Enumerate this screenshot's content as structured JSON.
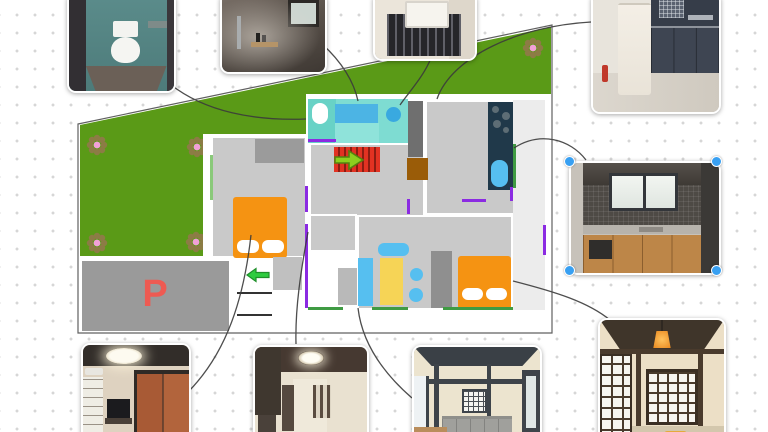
{
  "canvas": {
    "type": "floor-plan-photo-board",
    "background": "dot-grid"
  },
  "parking": {
    "label": "P",
    "color": "#ee5a52"
  },
  "palette": {
    "yard_green": "#5a9a17",
    "room_gray": "#c9c9c9",
    "bath_cyan": "#7edcd2",
    "water_blue": "#4fb9ee",
    "bed_orange": "#f59312",
    "stairs_red": "#e23222",
    "kitchen_navy": "#20394a",
    "entry_brown": "#9a5c08",
    "accent_purple": "#8b2be2",
    "accent_green": "#3f9b43",
    "selection_blue": "#38a0f2",
    "flower_petal": "#8c7c45",
    "flower_center": "#f2a0d8"
  },
  "photos": [
    {
      "id": "toilet-photo",
      "subject": "toilet room"
    },
    {
      "id": "shower-photo",
      "subject": "bathroom shower"
    },
    {
      "id": "sink-photo",
      "subject": "washbasin on rack"
    },
    {
      "id": "fridge-photo",
      "subject": "kitchen with refrigerator"
    },
    {
      "id": "counter-photo",
      "subject": "kitchen counter",
      "selected": true
    },
    {
      "id": "shoji-photo",
      "subject": "japanese room with shoji and pendant lamp"
    },
    {
      "id": "living-photo",
      "subject": "living room with sofa"
    },
    {
      "id": "hallway-photo",
      "subject": "hallway with stairs"
    },
    {
      "id": "tv-photo",
      "subject": "bedroom with tv and fusuma"
    }
  ],
  "selection": {
    "selected_photo": "counter-photo",
    "handle_color": "#38a0f2",
    "handles": 4
  },
  "plan": {
    "elements": [
      "yard",
      "flowers-x5",
      "toilet",
      "bathtub",
      "washbasin",
      "stairs-up-arrow",
      "entrance-mat",
      "kitchen-counter-stove-sink",
      "west-bed",
      "east-bed",
      "sofa",
      "dining-table",
      "stools",
      "tv-board",
      "closet",
      "parking",
      "entry-steps",
      "entry-arrow"
    ]
  },
  "connections": [
    {
      "from": "toilet-photo",
      "to": "plan-toilet"
    },
    {
      "from": "shower-photo",
      "to": "plan-bathtub"
    },
    {
      "from": "sink-photo",
      "to": "plan-washbasin"
    },
    {
      "from": "fridge-photo",
      "to": "plan-kitchen-room"
    },
    {
      "from": "counter-photo",
      "to": "plan-kitchen-counter"
    },
    {
      "from": "shoji-photo",
      "to": "plan-east-bed"
    },
    {
      "from": "living-photo",
      "to": "plan-living-area"
    },
    {
      "from": "hallway-photo",
      "to": "plan-corridor"
    },
    {
      "from": "tv-photo",
      "to": "plan-west-bedroom"
    }
  ]
}
